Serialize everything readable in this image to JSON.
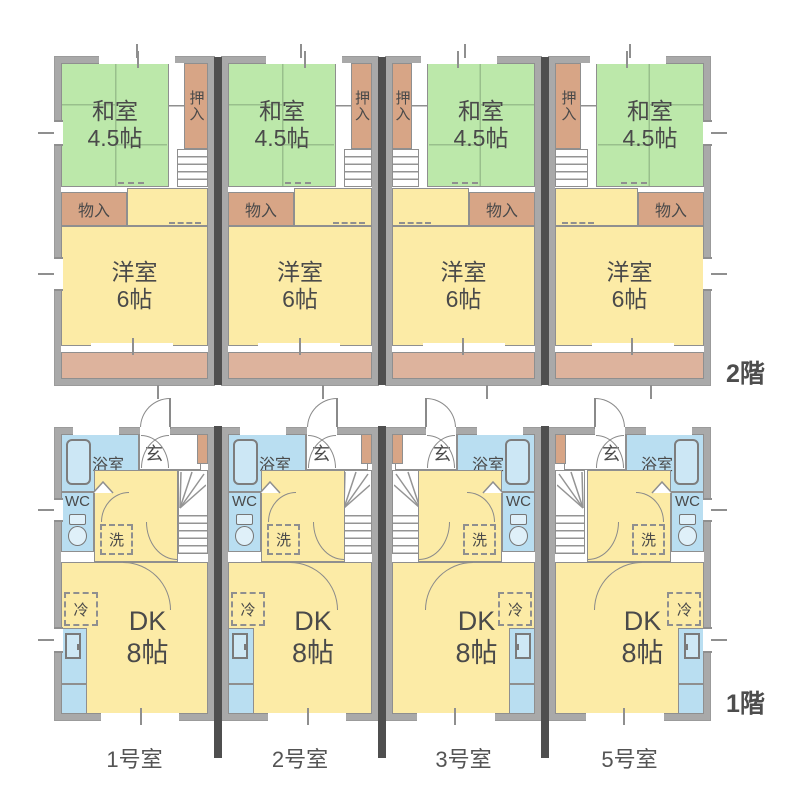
{
  "plan": {
    "type": "apartment-floor-plan",
    "floors": [
      {
        "id": "2f",
        "label": "2階"
      },
      {
        "id": "1f",
        "label": "1階"
      }
    ],
    "units": [
      {
        "name": "1号室"
      },
      {
        "name": "2号室"
      },
      {
        "name": "3号室"
      },
      {
        "name": "5号室"
      }
    ]
  },
  "labels": {
    "washitsu": "和室",
    "washitsu_size": "4.5帖",
    "oshiire": "押入",
    "monoire": "物入",
    "youshitsu": "洋室",
    "youshitsu_size": "6帖",
    "bath": "浴室",
    "entry": "玄",
    "wc": "WC",
    "laundry": "洗",
    "fridge": "冷",
    "dk": "DK",
    "dk_size": "8帖"
  },
  "colors": {
    "tatami_room": "#bce8aa",
    "western_room": "#fceba6",
    "closet": "#d7a586",
    "balcony": "#ddb39d",
    "water_area": "#b9def1",
    "outer_wall": "#a9a9a9",
    "thin_wall": "#8f8f8f",
    "unit_divider": "#4f4f4f",
    "text": "#4a4a4a"
  }
}
